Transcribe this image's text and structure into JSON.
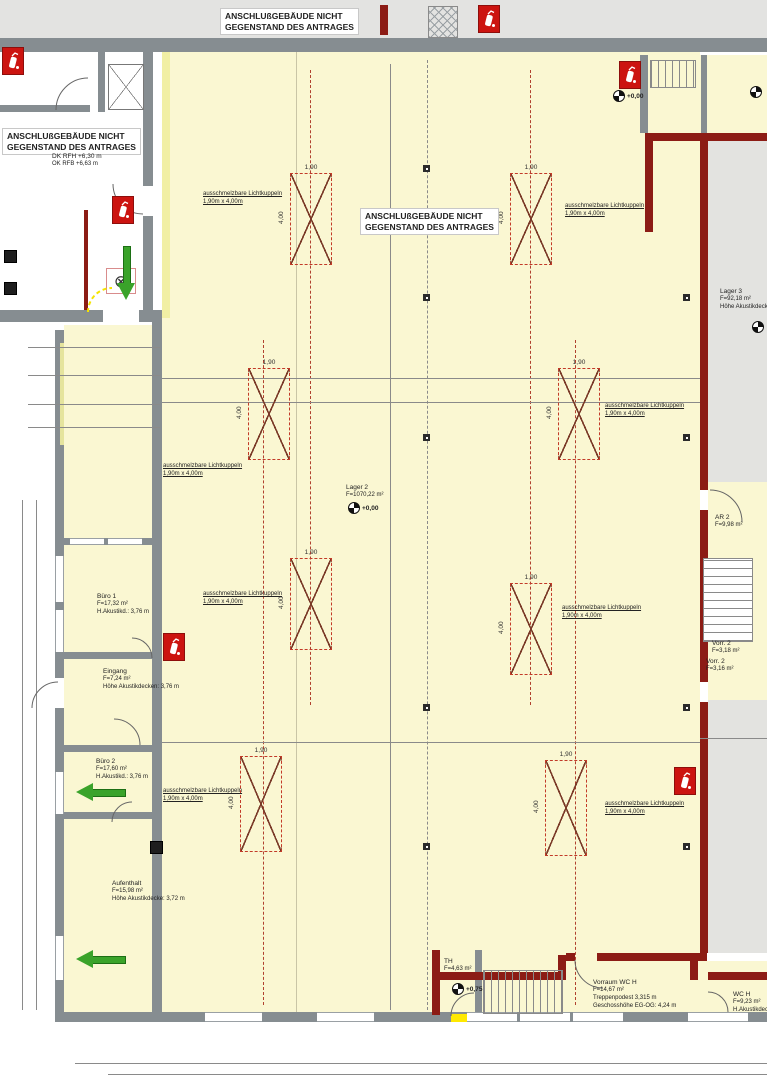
{
  "colors": {
    "floor": "#faf7d2",
    "floor2": "#e3e3e0",
    "wall": "#868d91",
    "redwall": "#8c1c15",
    "paleyellow": "#f0ed9e",
    "brightyellow": "#ffe900",
    "green": "#3aa32a",
    "skylight_red": "#c23a28",
    "margin_gray": "#e3e3e1"
  },
  "big_labels": [
    {
      "t": "1.070 m²",
      "x": 390,
      "y": 480,
      "size": 48
    },
    {
      "t": "Hochregal",
      "x": 390,
      "y": 536,
      "size": 44
    },
    {
      "t": "88 m² Büro",
      "x": 84,
      "y": 900,
      "size": 44
    }
  ],
  "notes": [
    {
      "x": 220,
      "y": 8,
      "lines": [
        "ANSCHLUßGEBÄUDE NICHT",
        "GEGENSTAND DES ANTRAGES"
      ]
    },
    {
      "x": 2,
      "y": 128,
      "lines": [
        "ANSCHLUßGEBÄUDE NICHT",
        "GEGENSTAND DES ANTRAGES"
      ]
    },
    {
      "x": 360,
      "y": 208,
      "lines": [
        "ANSCHLUßGEBÄUDE NICHT",
        "GEGENSTAND DES ANTRAGES"
      ]
    }
  ],
  "rooms": [
    {
      "x": 97,
      "y": 593,
      "lines": [
        "Büro 1",
        "F=17,32 m²",
        "H.Akustikd.: 3,76 m"
      ]
    },
    {
      "x": 103,
      "y": 668,
      "lines": [
        "Eingang",
        "F=7,24 m²",
        "Höhe Akustikdecken: 3,76 m"
      ]
    },
    {
      "x": 96,
      "y": 758,
      "lines": [
        "Büro 2",
        "F=17,60 m²",
        "H.Akustikd.: 3,76 m"
      ]
    },
    {
      "x": 112,
      "y": 880,
      "lines": [
        "Aufenthalt",
        "F=15,98 m²",
        "Höhe Akustikdecke: 3,72 m"
      ]
    },
    {
      "x": 346,
      "y": 484,
      "lines": [
        "Lager 2",
        "F=1070,22 m²"
      ]
    },
    {
      "x": 720,
      "y": 288,
      "lines": [
        "Lager 3",
        "F=92,18 m²",
        "Höhe Akustikdecke"
      ]
    },
    {
      "x": 444,
      "y": 958,
      "lines": [
        "TH",
        "F=4,63 m²"
      ]
    },
    {
      "x": 593,
      "y": 979,
      "lines": [
        "Vorraum WC H",
        "F=14,67 m²",
        "Treppenpodest 3,315 m",
        "Geschosshöhe EG-OG: 4,24 m"
      ]
    },
    {
      "x": 733,
      "y": 991,
      "lines": [
        "WC H",
        "F=9,23 m²",
        "H.Akustikdecke"
      ]
    },
    {
      "x": 715,
      "y": 514,
      "lines": [
        "AR 2",
        "F=9,98 m²"
      ]
    },
    {
      "x": 712,
      "y": 640,
      "lines": [
        "Vorr. 2",
        "F=3,18 m²"
      ]
    },
    {
      "x": 706,
      "y": 658,
      "lines": [
        "Vorr. 2",
        "F=3,16 m²"
      ]
    },
    {
      "x": 52,
      "y": 153,
      "lines": [
        "DK RFH +6,30 m",
        "OK RFB +6,63 m"
      ]
    }
  ],
  "skylight_label": {
    "l1": "ausschmelzbare Lichtkuppeln",
    "l2": "1,90m x 4,00m"
  },
  "skylights": [
    {
      "x": 290,
      "y": 173,
      "w": 42,
      "h": 92,
      "wd": "1,90",
      "hd": "4,00"
    },
    {
      "x": 510,
      "y": 173,
      "w": 42,
      "h": 92,
      "wd": "1,90",
      "hd": "4,00"
    },
    {
      "x": 248,
      "y": 368,
      "w": 42,
      "h": 92,
      "wd": "1,90",
      "hd": "4,00"
    },
    {
      "x": 558,
      "y": 368,
      "w": 42,
      "h": 92,
      "wd": "1,90",
      "hd": "4,00"
    },
    {
      "x": 290,
      "y": 558,
      "w": 42,
      "h": 92,
      "wd": "1,90",
      "hd": "4,00"
    },
    {
      "x": 510,
      "y": 583,
      "w": 42,
      "h": 92,
      "wd": "1,90",
      "hd": "4,00"
    },
    {
      "x": 240,
      "y": 756,
      "w": 42,
      "h": 96,
      "wd": "1,90",
      "hd": "4,00"
    },
    {
      "x": 545,
      "y": 760,
      "w": 42,
      "h": 96,
      "wd": "1,90",
      "hd": "4,00"
    }
  ],
  "skylight_labels": [
    {
      "x": 203,
      "y": 190
    },
    {
      "x": 565,
      "y": 202
    },
    {
      "x": 163,
      "y": 462
    },
    {
      "x": 605,
      "y": 402
    },
    {
      "x": 203,
      "y": 590
    },
    {
      "x": 562,
      "y": 604
    },
    {
      "x": 163,
      "y": 787
    },
    {
      "x": 605,
      "y": 800
    }
  ],
  "wall_labels": [
    {
      "t": "Brandwand",
      "x": 8,
      "y": 54
    },
    {
      "t": "Brandwand",
      "x": 270,
      "y": 54
    },
    {
      "t": "Brandwand",
      "x": 518,
      "y": 54
    },
    {
      "t": "Brandwand",
      "x": 714,
      "y": 57
    },
    {
      "t": "F90",
      "x": 6,
      "y": 97
    },
    {
      "t": "F90",
      "x": 42,
      "y": 97
    },
    {
      "t": "Bauart Brandwand",
      "x": 93,
      "y": 300,
      "r": -90
    },
    {
      "t": "Brandwand",
      "x": 147,
      "y": 145,
      "r": -90
    },
    {
      "t": "Brandwand",
      "x": 147,
      "y": 205,
      "r": -90
    },
    {
      "t": "F90BW",
      "x": 164,
      "y": 105,
      "r": -90
    },
    {
      "t": "F90BW",
      "x": 164,
      "y": 270,
      "r": -90
    },
    {
      "t": "F90AB",
      "x": 80,
      "y": 250,
      "r": -90
    },
    {
      "t": "F90AB",
      "x": 80,
      "y": 300,
      "r": -90
    },
    {
      "t": "F90 AB",
      "x": 118,
      "y": 187
    },
    {
      "t": "T 30 RS",
      "x": 90,
      "y": 198
    },
    {
      "t": "T 90",
      "x": 112,
      "y": 313
    },
    {
      "t": "Brandw.",
      "x": 60,
      "y": 313
    },
    {
      "t": "Brandwand",
      "x": 92,
      "y": 313
    },
    {
      "t": "Schlauchtr.",
      "x": 139,
      "y": 372,
      "r": -90
    },
    {
      "t": "Vordach Altbau",
      "x": 53,
      "y": 400,
      "r": -90
    },
    {
      "t": "Tor T90RS",
      "x": 644,
      "y": 118,
      "r": -90
    },
    {
      "t": "F90BW",
      "x": 718,
      "y": 141
    },
    {
      "t": "F90BW",
      "x": 699,
      "y": 372,
      "r": -90
    },
    {
      "t": "F90-AB",
      "x": 697,
      "y": 480,
      "r": -90
    },
    {
      "t": "T30RS",
      "x": 737,
      "y": 512,
      "r": -90
    },
    {
      "t": "F90BW",
      "x": 700,
      "y": 558,
      "r": -90
    },
    {
      "t": "F90-AB",
      "x": 741,
      "y": 578,
      "r": -90
    },
    {
      "t": "T30RS",
      "x": 709,
      "y": 680
    },
    {
      "t": "F90BW",
      "x": 699,
      "y": 852,
      "r": -90
    },
    {
      "t": "F90-AB",
      "x": 465,
      "y": 941
    },
    {
      "t": "F90-AB",
      "x": 532,
      "y": 966
    },
    {
      "t": "T30RS",
      "x": 571,
      "y": 954
    },
    {
      "t": "F90-AB",
      "x": 614,
      "y": 947
    },
    {
      "t": "F90 AB",
      "x": 430,
      "y": 998,
      "r": -90
    },
    {
      "t": "DS",
      "x": 698,
      "y": 1000,
      "r": -90
    },
    {
      "t": "BRH 1,72m",
      "x": 76,
      "y": 529
    },
    {
      "t": "BRH 1,73m",
      "x": 113,
      "y": 529
    },
    {
      "t": "BRH 1,73m",
      "x": 56,
      "y": 598,
      "r": -90
    },
    {
      "t": "BRH 1,73m",
      "x": 56,
      "y": 650,
      "r": -90
    },
    {
      "t": "BRH 1,00m",
      "x": 60,
      "y": 812,
      "r": -90
    },
    {
      "t": "BRH 1,00m",
      "x": 60,
      "y": 975,
      "r": -90
    },
    {
      "t": "BRH 2,06m",
      "x": 226,
      "y": 1023
    },
    {
      "t": "BRH 2,06m",
      "x": 338,
      "y": 1023
    },
    {
      "t": "BRH 2,06m",
      "x": 486,
      "y": 1023
    },
    {
      "t": "BRH 2,06m",
      "x": 539,
      "y": 1023
    },
    {
      "t": "BRH 2,06m",
      "x": 592,
      "y": 1023
    },
    {
      "t": "BRH 2,225m",
      "x": 702,
      "y": 1023
    },
    {
      "t": "B",
      "x": 50,
      "y": 330
    },
    {
      "t": "C ▷",
      "x": 285,
      "y": 1033
    },
    {
      "t": "Ausgang",
      "x": 445,
      "y": 1038
    },
    {
      "t": "◆",
      "x": 44,
      "y": 155
    }
  ],
  "dims": [
    {
      "t": "5,60",
      "x": 88,
      "y": 339
    },
    {
      "t": "3,82",
      "x": 102,
      "y": 366
    },
    {
      "t": "4,57",
      "x": 22,
      "y": 392,
      "r": -90
    },
    {
      "t": "5,09",
      "x": 70,
      "y": 394,
      "r": -90
    },
    {
      "t": "2,65",
      "x": 48,
      "y": 395
    },
    {
      "t": "16⁵",
      "x": 78,
      "y": 396
    },
    {
      "t": "2,84",
      "x": 109,
      "y": 395
    },
    {
      "t": "28",
      "x": 148,
      "y": 391
    },
    {
      "t": "2,65",
      "x": 48,
      "y": 418
    },
    {
      "t": "15⁵",
      "x": 78,
      "y": 419
    },
    {
      "t": "2,84",
      "x": 109,
      "y": 418
    },
    {
      "t": "25,24⁵",
      "x": 410,
      "y": 365
    },
    {
      "t": "12,01",
      "x": 238,
      "y": 393
    },
    {
      "t": "12,03",
      "x": 546,
      "y": 393
    },
    {
      "t": "28",
      "x": 413,
      "y": 393
    },
    {
      "t": "44,78⁵",
      "x": 378,
      "y": 538,
      "r": -90
    },
    {
      "t": "25,24⁵",
      "x": 410,
      "y": 729
    },
    {
      "t": "28",
      "x": 413,
      "y": 743
    },
    {
      "t": "5,38⁵",
      "x": 730,
      "y": 728
    },
    {
      "t": "3,49⁵",
      "x": 106,
      "y": 730
    },
    {
      "t": "38⁵",
      "x": 143,
      "y": 730
    },
    {
      "t": "1,08",
      "x": 22,
      "y": 520,
      "r": -90
    },
    {
      "t": "1,28",
      "x": 33,
      "y": 523,
      "r": -90
    },
    {
      "t": "1,78",
      "x": 21,
      "y": 568,
      "r": -90
    },
    {
      "t": "77",
      "x": 30,
      "y": 586,
      "r": -90
    },
    {
      "t": "0,90",
      "x": 37,
      "y": 596,
      "r": -90
    },
    {
      "t": "1,40",
      "x": 21,
      "y": 614,
      "r": -90
    },
    {
      "t": "74",
      "x": 21,
      "y": 636,
      "r": -90
    },
    {
      "t": "77",
      "x": 30,
      "y": 640,
      "r": -90
    },
    {
      "t": "0,90",
      "x": 37,
      "y": 644,
      "r": -90
    },
    {
      "t": "2,01",
      "x": 20,
      "y": 682,
      "r": -90
    },
    {
      "t": "3,61⁵",
      "x": 32,
      "y": 686,
      "r": -90
    },
    {
      "t": "3,78",
      "x": 20,
      "y": 738,
      "r": -90
    },
    {
      "t": "22,78",
      "x": 1,
      "y": 788,
      "r": -90
    },
    {
      "t": "2,58",
      "x": 20,
      "y": 782,
      "r": -90
    },
    {
      "t": "2,56",
      "x": 20,
      "y": 824,
      "r": -90
    },
    {
      "t": "2,45",
      "x": 20,
      "y": 876,
      "r": -90
    },
    {
      "t": "2,55",
      "x": 20,
      "y": 950,
      "r": -90
    },
    {
      "t": "1,98⁵",
      "x": 13,
      "y": 1000,
      "r": -90
    },
    {
      "t": "1,24",
      "x": 68,
      "y": 1055
    },
    {
      "t": "1,83",
      "x": 106,
      "y": 1055
    },
    {
      "t": "3,26",
      "x": 106,
      "y": 1066
    },
    {
      "t": "4,12⁵",
      "x": 168,
      "y": 1055
    },
    {
      "t": "1,83",
      "x": 234,
      "y": 1055
    },
    {
      "t": "3,26",
      "x": 234,
      "y": 1066
    },
    {
      "t": "2,51⁵",
      "x": 280,
      "y": 1055
    },
    {
      "t": "3,26",
      "x": 280,
      "y": 1066
    },
    {
      "t": "68",
      "x": 316,
      "y": 1055
    },
    {
      "t": "1,83",
      "x": 340,
      "y": 1055
    },
    {
      "t": "3,26",
      "x": 340,
      "y": 1066
    },
    {
      "t": "5,50",
      "x": 404,
      "y": 1055
    },
    {
      "t": "1,83",
      "x": 495,
      "y": 1055
    },
    {
      "t": "3,26",
      "x": 495,
      "y": 1066
    },
    {
      "t": "67",
      "x": 524,
      "y": 1055
    },
    {
      "t": "1,83",
      "x": 550,
      "y": 1055
    },
    {
      "t": "3,26",
      "x": 550,
      "y": 1066
    },
    {
      "t": "65",
      "x": 578,
      "y": 1055
    },
    {
      "t": "1,83",
      "x": 601,
      "y": 1055
    },
    {
      "t": "3,26",
      "x": 601,
      "y": 1066
    },
    {
      "t": "3,79",
      "x": 674,
      "y": 1055
    },
    {
      "t": "1,19",
      "x": 718,
      "y": 1055
    },
    {
      "t": "0,645",
      "x": 718,
      "y": 1066
    },
    {
      "t": "76",
      "x": 743,
      "y": 1055
    },
    {
      "t": "1,1",
      "x": 758,
      "y": 1055
    },
    {
      "t": "0,6",
      "x": 758,
      "y": 1066
    }
  ],
  "levels": [
    {
      "x": 613,
      "y": 90,
      "t": "+0,00"
    },
    {
      "x": 750,
      "y": 86,
      "t": ""
    },
    {
      "x": 348,
      "y": 502,
      "t": "+0,00"
    },
    {
      "x": 752,
      "y": 321,
      "t": ""
    },
    {
      "x": 452,
      "y": 983,
      "t": "+0,75"
    }
  ],
  "extinguishers": [
    {
      "x": 2,
      "y": 47
    },
    {
      "x": 112,
      "y": 196
    },
    {
      "x": 478,
      "y": 5
    },
    {
      "x": 619,
      "y": 61
    },
    {
      "x": 163,
      "y": 633
    },
    {
      "x": 674,
      "y": 767
    }
  ],
  "arrows": [
    {
      "x": 117,
      "y": 246,
      "dir": "down"
    },
    {
      "x": 76,
      "y": 783,
      "dir": "left"
    },
    {
      "x": 76,
      "y": 950,
      "dir": "left"
    }
  ],
  "columns": [
    {
      "x": 423,
      "y": 165
    },
    {
      "x": 423,
      "y": 294
    },
    {
      "x": 423,
      "y": 434
    },
    {
      "x": 423,
      "y": 704
    },
    {
      "x": 423,
      "y": 843
    },
    {
      "x": 683,
      "y": 294
    },
    {
      "x": 683,
      "y": 434
    },
    {
      "x": 683,
      "y": 704
    },
    {
      "x": 683,
      "y": 843
    }
  ],
  "furniture": [
    {
      "x": 4,
      "y": 250
    },
    {
      "x": 4,
      "y": 282
    },
    {
      "x": 150,
      "y": 841
    }
  ]
}
